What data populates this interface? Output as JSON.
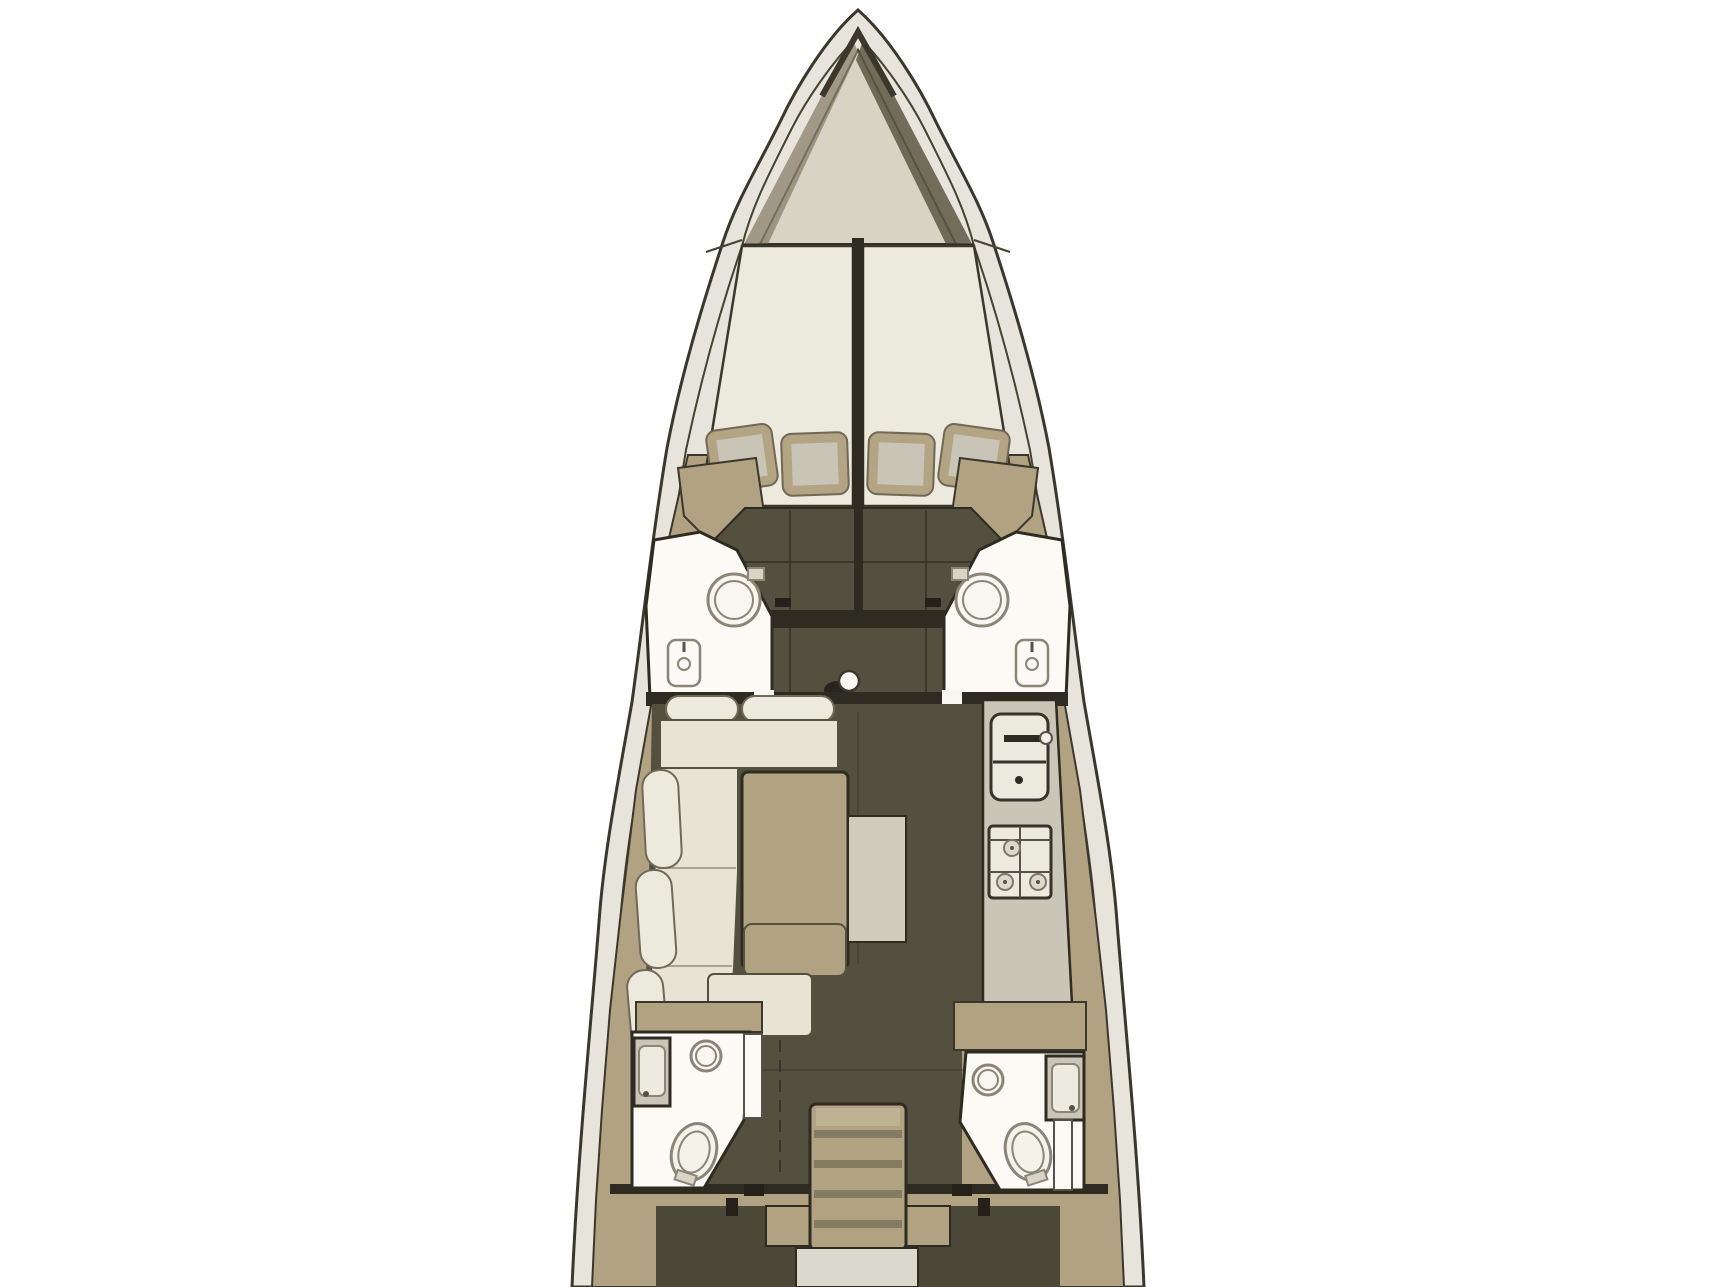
{
  "diagram": {
    "type": "floor-plan",
    "subject": "sailing-yacht-interior-layout-top-view",
    "orientation": "bow-up",
    "regions": [
      {
        "id": "anchor-locker",
        "label": "Anchor locker at bow"
      },
      {
        "id": "forward-cabin",
        "label": "Forward cabin with twin V-berths and four pillows"
      },
      {
        "id": "forward-head-port",
        "label": "Forward port bathroom with toilet and washbasin"
      },
      {
        "id": "forward-head-starboard",
        "label": "Forward starboard bathroom with toilet and washbasin"
      },
      {
        "id": "mast-post",
        "label": "Mast compression post"
      },
      {
        "id": "saloon",
        "label": "Saloon with U-shaped settee, table and stool bench"
      },
      {
        "id": "galley",
        "label": "Galley with sink unit and stove with three burners"
      },
      {
        "id": "aft-head-port",
        "label": "Aft port bathroom with shower, washbasin and toilet"
      },
      {
        "id": "aft-head-starboard",
        "label": "Aft starboard bathroom with shower, washbasin and toilet"
      },
      {
        "id": "companionway",
        "label": "Companionway stairs with four treads"
      },
      {
        "id": "aft-cabin-port",
        "label": "Aft port cabin entrance"
      },
      {
        "id": "aft-cabin-starboard",
        "label": "Aft starboard cabin entrance"
      }
    ]
  },
  "colors": {
    "background": "#ffffff",
    "hull_shell": "#e6e4db",
    "outline": "#3a382c",
    "deck_tan": "#b1a382",
    "locker_floor": "#d7d3c5",
    "locker_shade": "#8a8068",
    "bed_cream": "#eceadd",
    "upholstery": "#e7e4d6",
    "bolster": "#eceadd",
    "pillow_border": "#b3a584",
    "pillow_center": "#c8c5b6",
    "floor_dark": "#53503f",
    "floor_band": "#2e2b20",
    "cabin_dark": "#4c4837",
    "fixture_white": "#fbfaf4",
    "fixture_outline": "#8a8577",
    "counter": "#c9c6b8",
    "module_gray": "#cfccbe",
    "tread_shadow": "#837b62",
    "step_light": "#dbd9cd"
  }
}
